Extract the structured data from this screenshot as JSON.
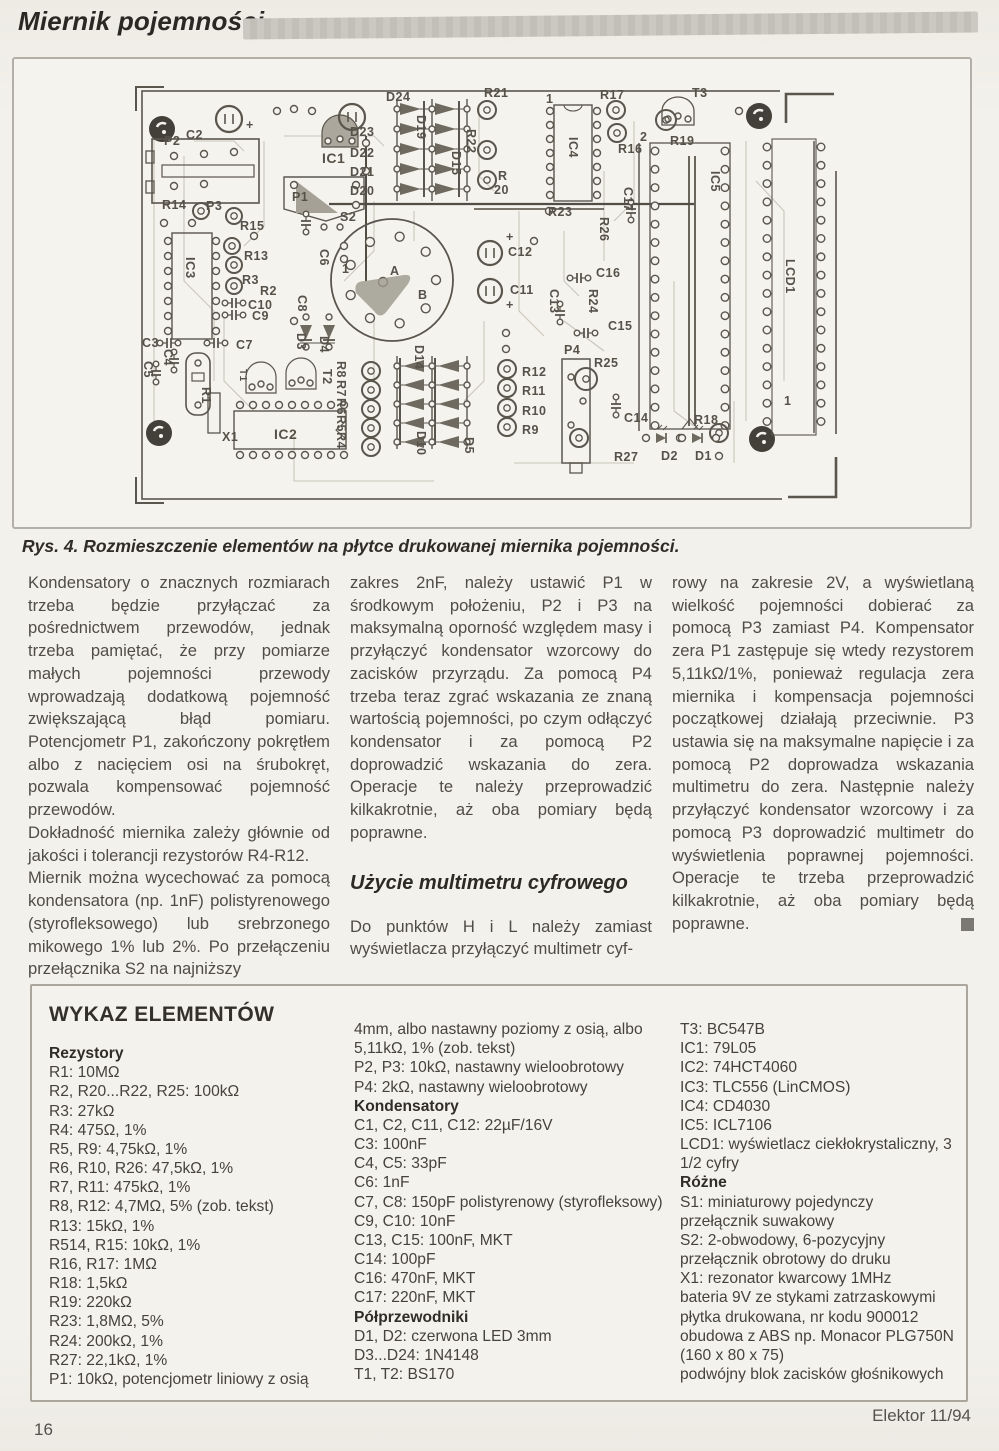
{
  "header": {
    "title": "Miernik pojemności"
  },
  "figure": {
    "caption": "Rys. 4. Rozmieszczenie elementów na płytce drukowanej miernika pojemności.",
    "pcb_labels": [
      {
        "t": "P2",
        "x": 30,
        "y": 64
      },
      {
        "t": "C2",
        "x": 52,
        "y": 58
      },
      {
        "t": "+",
        "x": 112,
        "y": 48
      },
      {
        "t": "IC1",
        "x": 188,
        "y": 82,
        "s": 14
      },
      {
        "t": "P1",
        "x": 158,
        "y": 120
      },
      {
        "t": "D24",
        "x": 252,
        "y": 20
      },
      {
        "t": "D23",
        "x": 216,
        "y": 55
      },
      {
        "t": "D22",
        "x": 216,
        "y": 76
      },
      {
        "t": "D21",
        "x": 216,
        "y": 95
      },
      {
        "t": "D20",
        "x": 216,
        "y": 114
      },
      {
        "t": "D19",
        "x": 283,
        "y": 34,
        "r": 1
      },
      {
        "t": "D15",
        "x": 318,
        "y": 70,
        "r": 1
      },
      {
        "t": "R22",
        "x": 333,
        "y": 48,
        "r": 1
      },
      {
        "t": "R21",
        "x": 350,
        "y": 16
      },
      {
        "t": "R17",
        "x": 466,
        "y": 18
      },
      {
        "t": "T3",
        "x": 558,
        "y": 16
      },
      {
        "t": "1",
        "x": 412,
        "y": 22
      },
      {
        "t": "IC4",
        "x": 435,
        "y": 56,
        "r": 1
      },
      {
        "t": "R16",
        "x": 484,
        "y": 72
      },
      {
        "t": "R19",
        "x": 536,
        "y": 64
      },
      {
        "t": "2",
        "x": 506,
        "y": 60
      },
      {
        "t": "R",
        "x": 364,
        "y": 99
      },
      {
        "t": "20",
        "x": 360,
        "y": 113
      },
      {
        "t": "IC5",
        "x": 577,
        "y": 90,
        "r": 1
      },
      {
        "t": "LCD1",
        "x": 652,
        "y": 178,
        "r": 1
      },
      {
        "t": "C17",
        "x": 490,
        "y": 106,
        "r": 1
      },
      {
        "t": "R23",
        "x": 414,
        "y": 135
      },
      {
        "t": "R26",
        "x": 466,
        "y": 136,
        "r": 1
      },
      {
        "t": "C12",
        "x": 374,
        "y": 175
      },
      {
        "t": "+",
        "x": 372,
        "y": 160
      },
      {
        "t": "C16",
        "x": 462,
        "y": 196
      },
      {
        "t": "C11",
        "x": 376,
        "y": 213
      },
      {
        "t": "+",
        "x": 372,
        "y": 228
      },
      {
        "t": "C13",
        "x": 416,
        "y": 208,
        "r": 1
      },
      {
        "t": "R24",
        "x": 455,
        "y": 208,
        "r": 1
      },
      {
        "t": "C15",
        "x": 474,
        "y": 249
      },
      {
        "t": "P4",
        "x": 430,
        "y": 273
      },
      {
        "t": "R25",
        "x": 460,
        "y": 286
      },
      {
        "t": "C14",
        "x": 490,
        "y": 341
      },
      {
        "t": "R27",
        "x": 480,
        "y": 380
      },
      {
        "t": "D2",
        "x": 527,
        "y": 379
      },
      {
        "t": "D1",
        "x": 561,
        "y": 379
      },
      {
        "t": "R18",
        "x": 560,
        "y": 343
      },
      {
        "t": "R12",
        "x": 388,
        "y": 295
      },
      {
        "t": "R11",
        "x": 388,
        "y": 314
      },
      {
        "t": "R10",
        "x": 388,
        "y": 334
      },
      {
        "t": "R9",
        "x": 388,
        "y": 353
      },
      {
        "t": "R14",
        "x": 28,
        "y": 128
      },
      {
        "t": "P3",
        "x": 72,
        "y": 129
      },
      {
        "t": "R15",
        "x": 106,
        "y": 149
      },
      {
        "t": "R13",
        "x": 110,
        "y": 179
      },
      {
        "t": "R3",
        "x": 108,
        "y": 203
      },
      {
        "t": "R2",
        "x": 126,
        "y": 214
      },
      {
        "t": "C10",
        "x": 114,
        "y": 228
      },
      {
        "t": "C9",
        "x": 118,
        "y": 239
      },
      {
        "t": "C7",
        "x": 102,
        "y": 268
      },
      {
        "t": "C3",
        "x": 8,
        "y": 266
      },
      {
        "t": "C4",
        "x": 30,
        "y": 268,
        "r": 1
      },
      {
        "t": "C5",
        "x": 10,
        "y": 280,
        "r": 1
      },
      {
        "t": "C6",
        "x": 186,
        "y": 168,
        "r": 1
      },
      {
        "t": "C8",
        "x": 164,
        "y": 214,
        "r": 1
      },
      {
        "t": "IC3",
        "x": 52,
        "y": 176,
        "r": 1,
        "s": 13
      },
      {
        "t": "S2",
        "x": 206,
        "y": 140
      },
      {
        "t": "1",
        "x": 208,
        "y": 192
      },
      {
        "t": "A",
        "x": 256,
        "y": 194
      },
      {
        "t": "B",
        "x": 284,
        "y": 218
      },
      {
        "t": "X1",
        "x": 88,
        "y": 360
      },
      {
        "t": "R1",
        "x": 68,
        "y": 306,
        "r": 1
      },
      {
        "t": "IC2",
        "x": 140,
        "y": 358,
        "s": 14
      },
      {
        "t": "T1",
        "x": 106,
        "y": 288,
        "r": 1,
        "s": 10
      },
      {
        "t": "T2",
        "x": 189,
        "y": 288,
        "r": 1
      },
      {
        "t": "D3",
        "x": 163,
        "y": 252,
        "r": 1
      },
      {
        "t": "D4",
        "x": 186,
        "y": 255,
        "r": 1
      },
      {
        "t": "R8",
        "x": 203,
        "y": 280,
        "r": 1
      },
      {
        "t": "R7",
        "x": 203,
        "y": 299,
        "r": 1
      },
      {
        "t": "R6",
        "x": 203,
        "y": 317,
        "r": 1
      },
      {
        "t": "R5",
        "x": 203,
        "y": 334,
        "r": 1
      },
      {
        "t": "R4",
        "x": 203,
        "y": 351,
        "r": 1
      },
      {
        "t": "D14",
        "x": 281,
        "y": 264,
        "r": 1
      },
      {
        "t": "D10",
        "x": 283,
        "y": 350,
        "r": 1
      },
      {
        "t": "D5",
        "x": 331,
        "y": 356,
        "r": 1
      },
      {
        "t": "1",
        "x": 650,
        "y": 324
      }
    ]
  },
  "article": {
    "col1": [
      "Kondensatory o znacznych rozmiarach trzeba będzie przyłączać za pośrednictwem przewodów, jednak trzeba pamiętać, że przy pomiarze małych pojemności przewody wprowadzają dodatkową pojemność zwiększającą błąd pomiaru. Potencjometr P1, zakończony pokrętłem albo z  nacięciem osi na śrubokręt, pozwala kompensować pojemność przewodów.",
      "Dokładność miernika zależy głównie od jakości i  tolerancji rezystorów R4-R12.",
      "Miernik można wycechować za pomocą kondensatora (np. 1nF) polistyrenowego (styrofleksowego) lub srebrzonego mikowego 1% lub 2%. Po przełączeniu przełącznika S2 na najniższy"
    ],
    "col2a": [
      "zakres 2nF, należy ustawić P1 w  środkowym położeniu, P2 i  P3 na maksymalną oporność względem masy i  przyłączyć kondensator wzorcowy do zacisków przyrządu. Za pomocą P4 trzeba teraz zgrać wskazania ze znaną wartością pojemności, po czym odłączyć kondensator i  za pomocą P2 doprowadzić wskazania do zera. Operacje te należy przeprowadzić kilkakrotnie, aż oba pomiary będą poprawne."
    ],
    "col2_heading": "Użycie multimetru cyfrowego",
    "col2b": [
      "Do punktów H i L należy zamiast wyświetlacza przyłączyć multimetr cyf-"
    ],
    "col3": [
      "rowy na zakresie 2V, a wyświetlaną wielkość pojemności dobierać za pomocą P3 zamiast P4. Kompensator zera P1 zastępuje się wtedy rezystorem 5,11kΩ/1%, ponieważ regulacja zera miernika i kompensacja pojemności początkowej działają przeciwnie. P3 ustawia się na maksymalne napięcie i  za pomocą P2 doprowadza wskazania multimetru do zera. Następnie należy przyłączyć kondensator wzorcowy i  za pomocą P3 doprowadzić multimetr do wyświetlenia poprawnej pojemności. Operacje te trzeba przeprowadzić kilkakrotnie, aż oba pomiary będą poprawne."
    ]
  },
  "parts": {
    "title": "WYKAZ ELEMENTÓW",
    "col1": [
      {
        "t": "Rezystory",
        "b": 1
      },
      "R1: 10MΩ",
      "R2, R20...R22, R25: 100kΩ",
      "R3: 27kΩ",
      "R4: 475Ω, 1%",
      "R5, R9: 4,75kΩ, 1%",
      "R6, R10, R26: 47,5kΩ, 1%",
      "R7, R11: 475kΩ, 1%",
      "R8, R12: 4,7MΩ, 5% (zob. tekst)",
      "R13: 15kΩ, 1%",
      "R514, R15: 10kΩ, 1%",
      "R16, R17: 1MΩ",
      "R18: 1,5kΩ",
      "R19: 220kΩ",
      "R23: 1,8MΩ, 5%",
      "R24: 200kΩ, 1%",
      "R27: 22,1kΩ, 1%",
      "P1: 10kΩ, potencjometr liniowy z osią"
    ],
    "col2": [
      "4mm, albo nastawny poziomy z osią, albo",
      "5,11kΩ, 1% (zob. tekst)",
      "P2, P3: 10kΩ, nastawny wieloobrotowy",
      "P4: 2kΩ, nastawny wieloobrotowy",
      {
        "t": "Kondensatory",
        "b": 1
      },
      "C1, C2, C11, C12: 22µF/16V",
      "C3: 100nF",
      "C4, C5: 33pF",
      "C6: 1nF",
      "C7, C8: 150pF polistyrenowy (styrofleksowy)",
      "C9, C10: 10nF",
      "C13, C15: 100nF, MKT",
      "C14: 100pF",
      "C16: 470nF, MKT",
      "C17: 220nF, MKT",
      {
        "t": "Półprzewodniki",
        "b": 1
      },
      "D1, D2: czerwona LED  3mm",
      "D3...D24: 1N4148",
      "T1, T2: BS170"
    ],
    "col3": [
      "T3: BC547B",
      "IC1: 79L05",
      "IC2: 74HCT4060",
      "IC3: TLC556 (LinCMOS)",
      "IC4: CD4030",
      "IC5: ICL7106",
      "LCD1: wyświetlacz ciekłokrystaliczny, 3 1/2 cyfry",
      {
        "t": "Różne",
        "b": 1
      },
      "S1: miniaturowy pojedynczy przełącznik suwakowy",
      "S2: 2-obwodowy, 6-pozycyjny przełącznik obrotowy do druku",
      "X1: rezonator kwarcowy 1MHz",
      "bateria 9V ze stykami zatrzaskowymi",
      "płytka drukowana, nr kodu 900012",
      "obudowa z ABS np. Monacor PLG750N (160 x 80 x 75)",
      "podwójny blok zacisków głośnikowych"
    ]
  },
  "footer": {
    "page_number": "16",
    "journal": "Elektor 11/94"
  },
  "colors": {
    "paper": "#f1efe9",
    "ink": "#4e4a46",
    "bar_gray": "#c8c5bf",
    "pcb_ink": "#57534b"
  }
}
